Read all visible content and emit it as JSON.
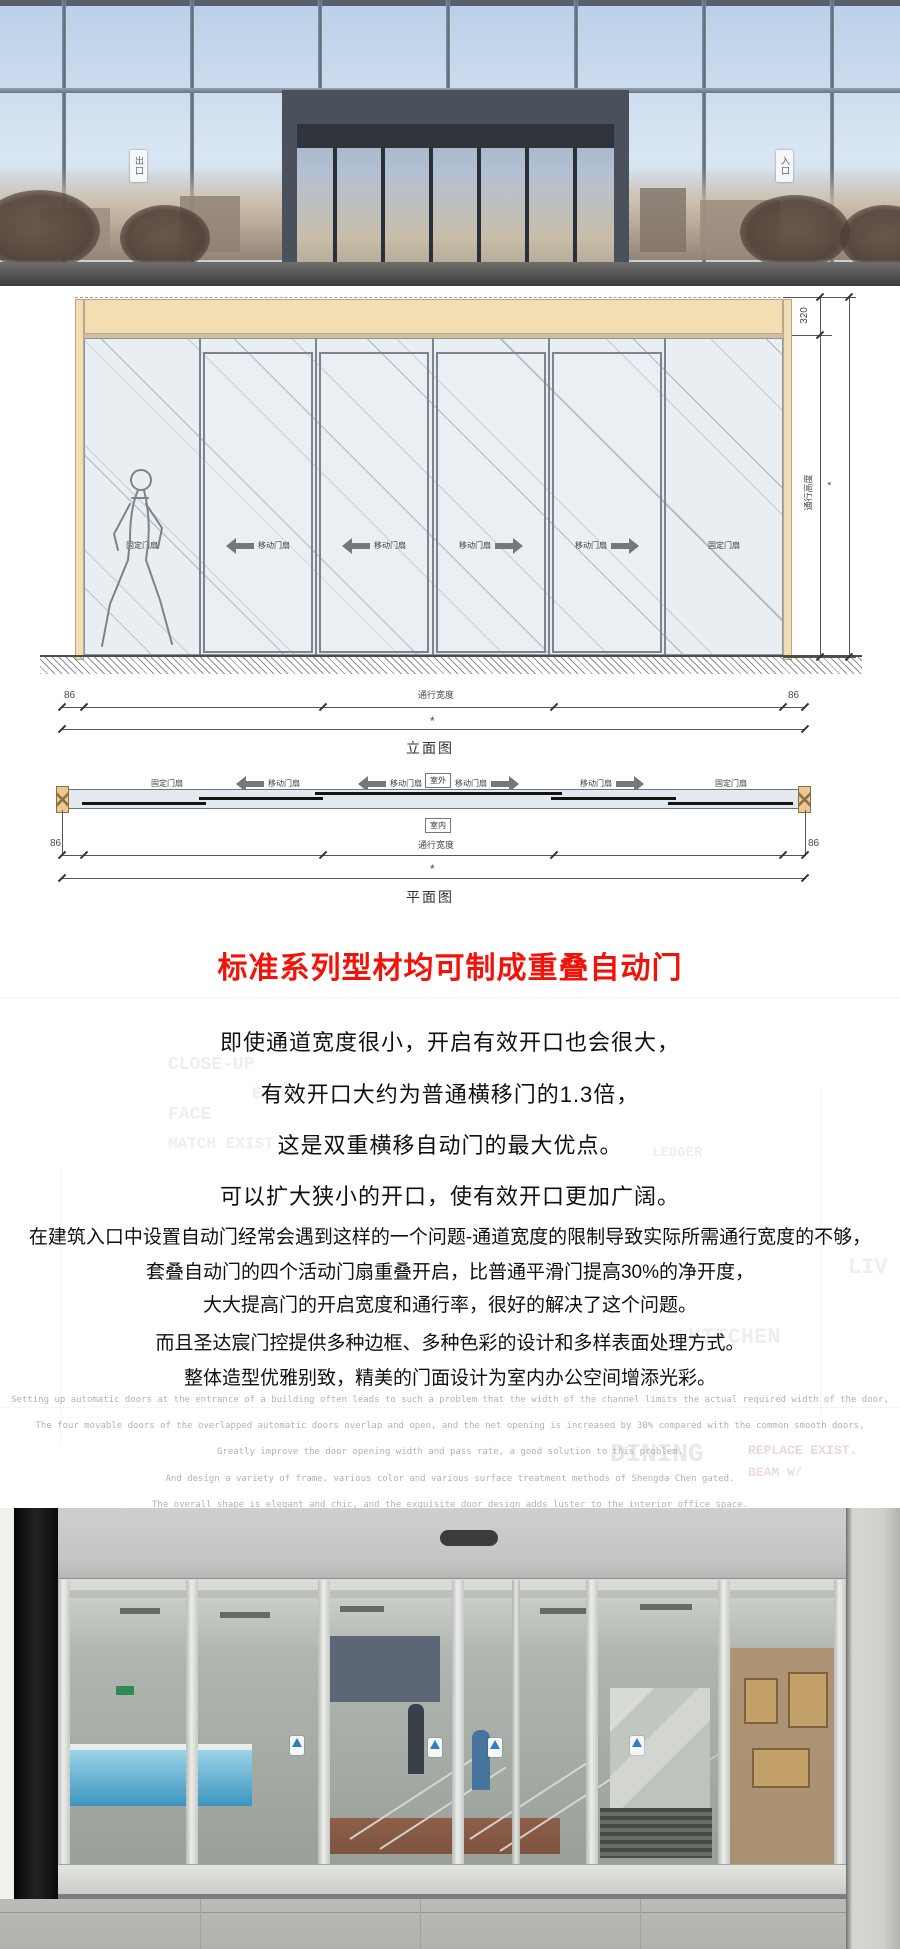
{
  "hero": {
    "exit_sign": "出口",
    "entrance_sign": "入口"
  },
  "elevation": {
    "caption": "立面图",
    "panel_labels": [
      "固定门扇",
      "移动门扇",
      "移动门扇",
      "移动门扇",
      "移动门扇",
      "固定门扇"
    ],
    "dims": {
      "header_height": "320",
      "height_label": "通行高度",
      "height_star": "*",
      "left": "86",
      "right": "86",
      "width_label": "通行宽度",
      "width_star": "*"
    }
  },
  "plan": {
    "caption": "平面图",
    "outside_label": "室外",
    "inside_label": "室内",
    "panel_labels": [
      "固定门扇",
      "移动门扇",
      "移动门扇",
      "移动门扇",
      "移动门扇",
      "固定门扇"
    ],
    "dims": {
      "left": "86",
      "right": "86",
      "width_label": "通行宽度",
      "width_star": "*"
    }
  },
  "title": {
    "text": "标准系列型材均可制成重叠自动门",
    "color": "#f31208"
  },
  "features_cn": [
    "即使通道宽度很小，开启有效开口也会很大，",
    "有效开口大约为普通横移门的1.3倍，",
    "这是双重横移自动门的最大优点。",
    "可以扩大狭小的开口，使有效开口更加广阔。"
  ],
  "details_cn": [
    "在建筑入口中设置自动门经常会遇到这样的一个问题-通道宽度的限制导致实际所需通行宽度的不够，",
    "套叠自动门的四个活动门扇重叠开启，比普通平滑门提高30%的净开度，",
    "大大提高门的开启宽度和通行率，很好的解决了这个问题。",
    "而且圣达宸门控提供多种边框、多种色彩的设计和多样表面处理方式。",
    "整体造型优雅别致，精美的门面设计为室内办公空间增添光彩。"
  ],
  "details_en": [
    "Setting up automatic doors at the entrance of a building often leads to such a problem that the width of the channel limits the actual required width of the door,",
    "The four movable doors of the overlapped automatic doors overlap and open, and the net opening is increased by 30% compared with the common smooth doors,",
    "Greatly improve the door opening width and pass rate, a good solution to this problem.",
    "And design a variety of frame, various color and various surface treatment methods of Shengda Chen gated.",
    "The overall shape is elegant and chic, and the exquisite door design adds luster to the interior office space."
  ],
  "watermark": [
    "CLOSE-UP",
    "EXIST.",
    "FACE",
    "MATCH EXIST.",
    "LEDGER",
    "KITCHEN",
    "DINING",
    "REPLACE EXIST.",
    "BEAM W/",
    "LIV"
  ]
}
